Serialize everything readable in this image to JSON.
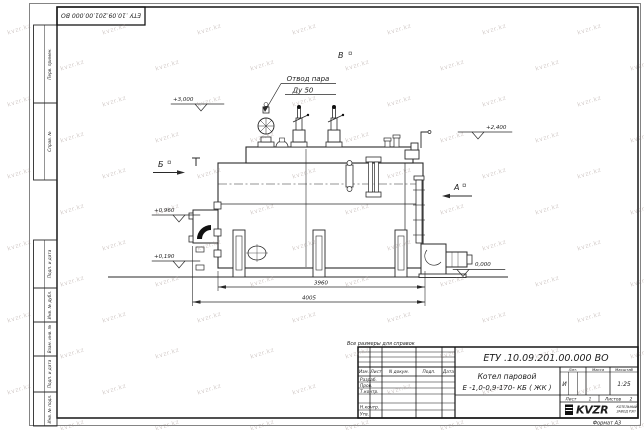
{
  "sheet": {
    "top_stamp": "ЕТУ .10.09.201.00.000  ВО",
    "reference_note": "Все размеры для справок",
    "format_label": "Формат А3"
  },
  "frame_fields": [
    "Перв. примен.",
    "Справ. №",
    "Подп. и дата",
    "Инв. № дубл.",
    "Взам. инв. №",
    "Подп. и дата",
    "Инв. № подл."
  ],
  "title_block": {
    "designation": "ЕТУ .10.09.201.00.000  ВО",
    "product_name_line1": "Котел паровой",
    "product_name_line2": "Е -1,0-0,9-170- КБ ( ЖК )",
    "col_izm": "Изм.",
    "col_list": "Лист",
    "col_ndokum": "N докум.",
    "col_podp": "Подп.",
    "col_data": "Дата",
    "row_razrab": "Разраб.",
    "row_prov": "Пров.",
    "row_tkontr": "Т.контр.",
    "row_nkontr": "Н.контр.",
    "row_utv": "Утв.",
    "lit_header": "Лит.",
    "massa_header": "Масса",
    "masshtab_header": "Масштаб",
    "lit_value": "И",
    "scale": "1:25",
    "sheet_label": "Лист",
    "sheet_value": "1",
    "sheets_label": "Листов",
    "sheets_value": "2",
    "company_logo": "KVZR",
    "company_line1": "КОТЕЛЬНЫЙ",
    "company_line2": "ЗАВОД РЭП"
  },
  "drawing": {
    "callout_line1": "Отвод пара",
    "callout_line2": "Ду 50",
    "view_v": "В",
    "view_b": "Б",
    "view_a": "А",
    "elev_3000": "+3,000",
    "elev_2400": "+2,400",
    "elev_0960": "+0,960",
    "elev_0190": "+0,190",
    "elev_0000": "0,000",
    "dim_3960": "3960",
    "dim_4005": "4005"
  },
  "watermark": {
    "text": "kvzr.kz"
  },
  "colors": {
    "line": "#2a2a2a",
    "frame": "#161616",
    "watermark": "#988882"
  }
}
